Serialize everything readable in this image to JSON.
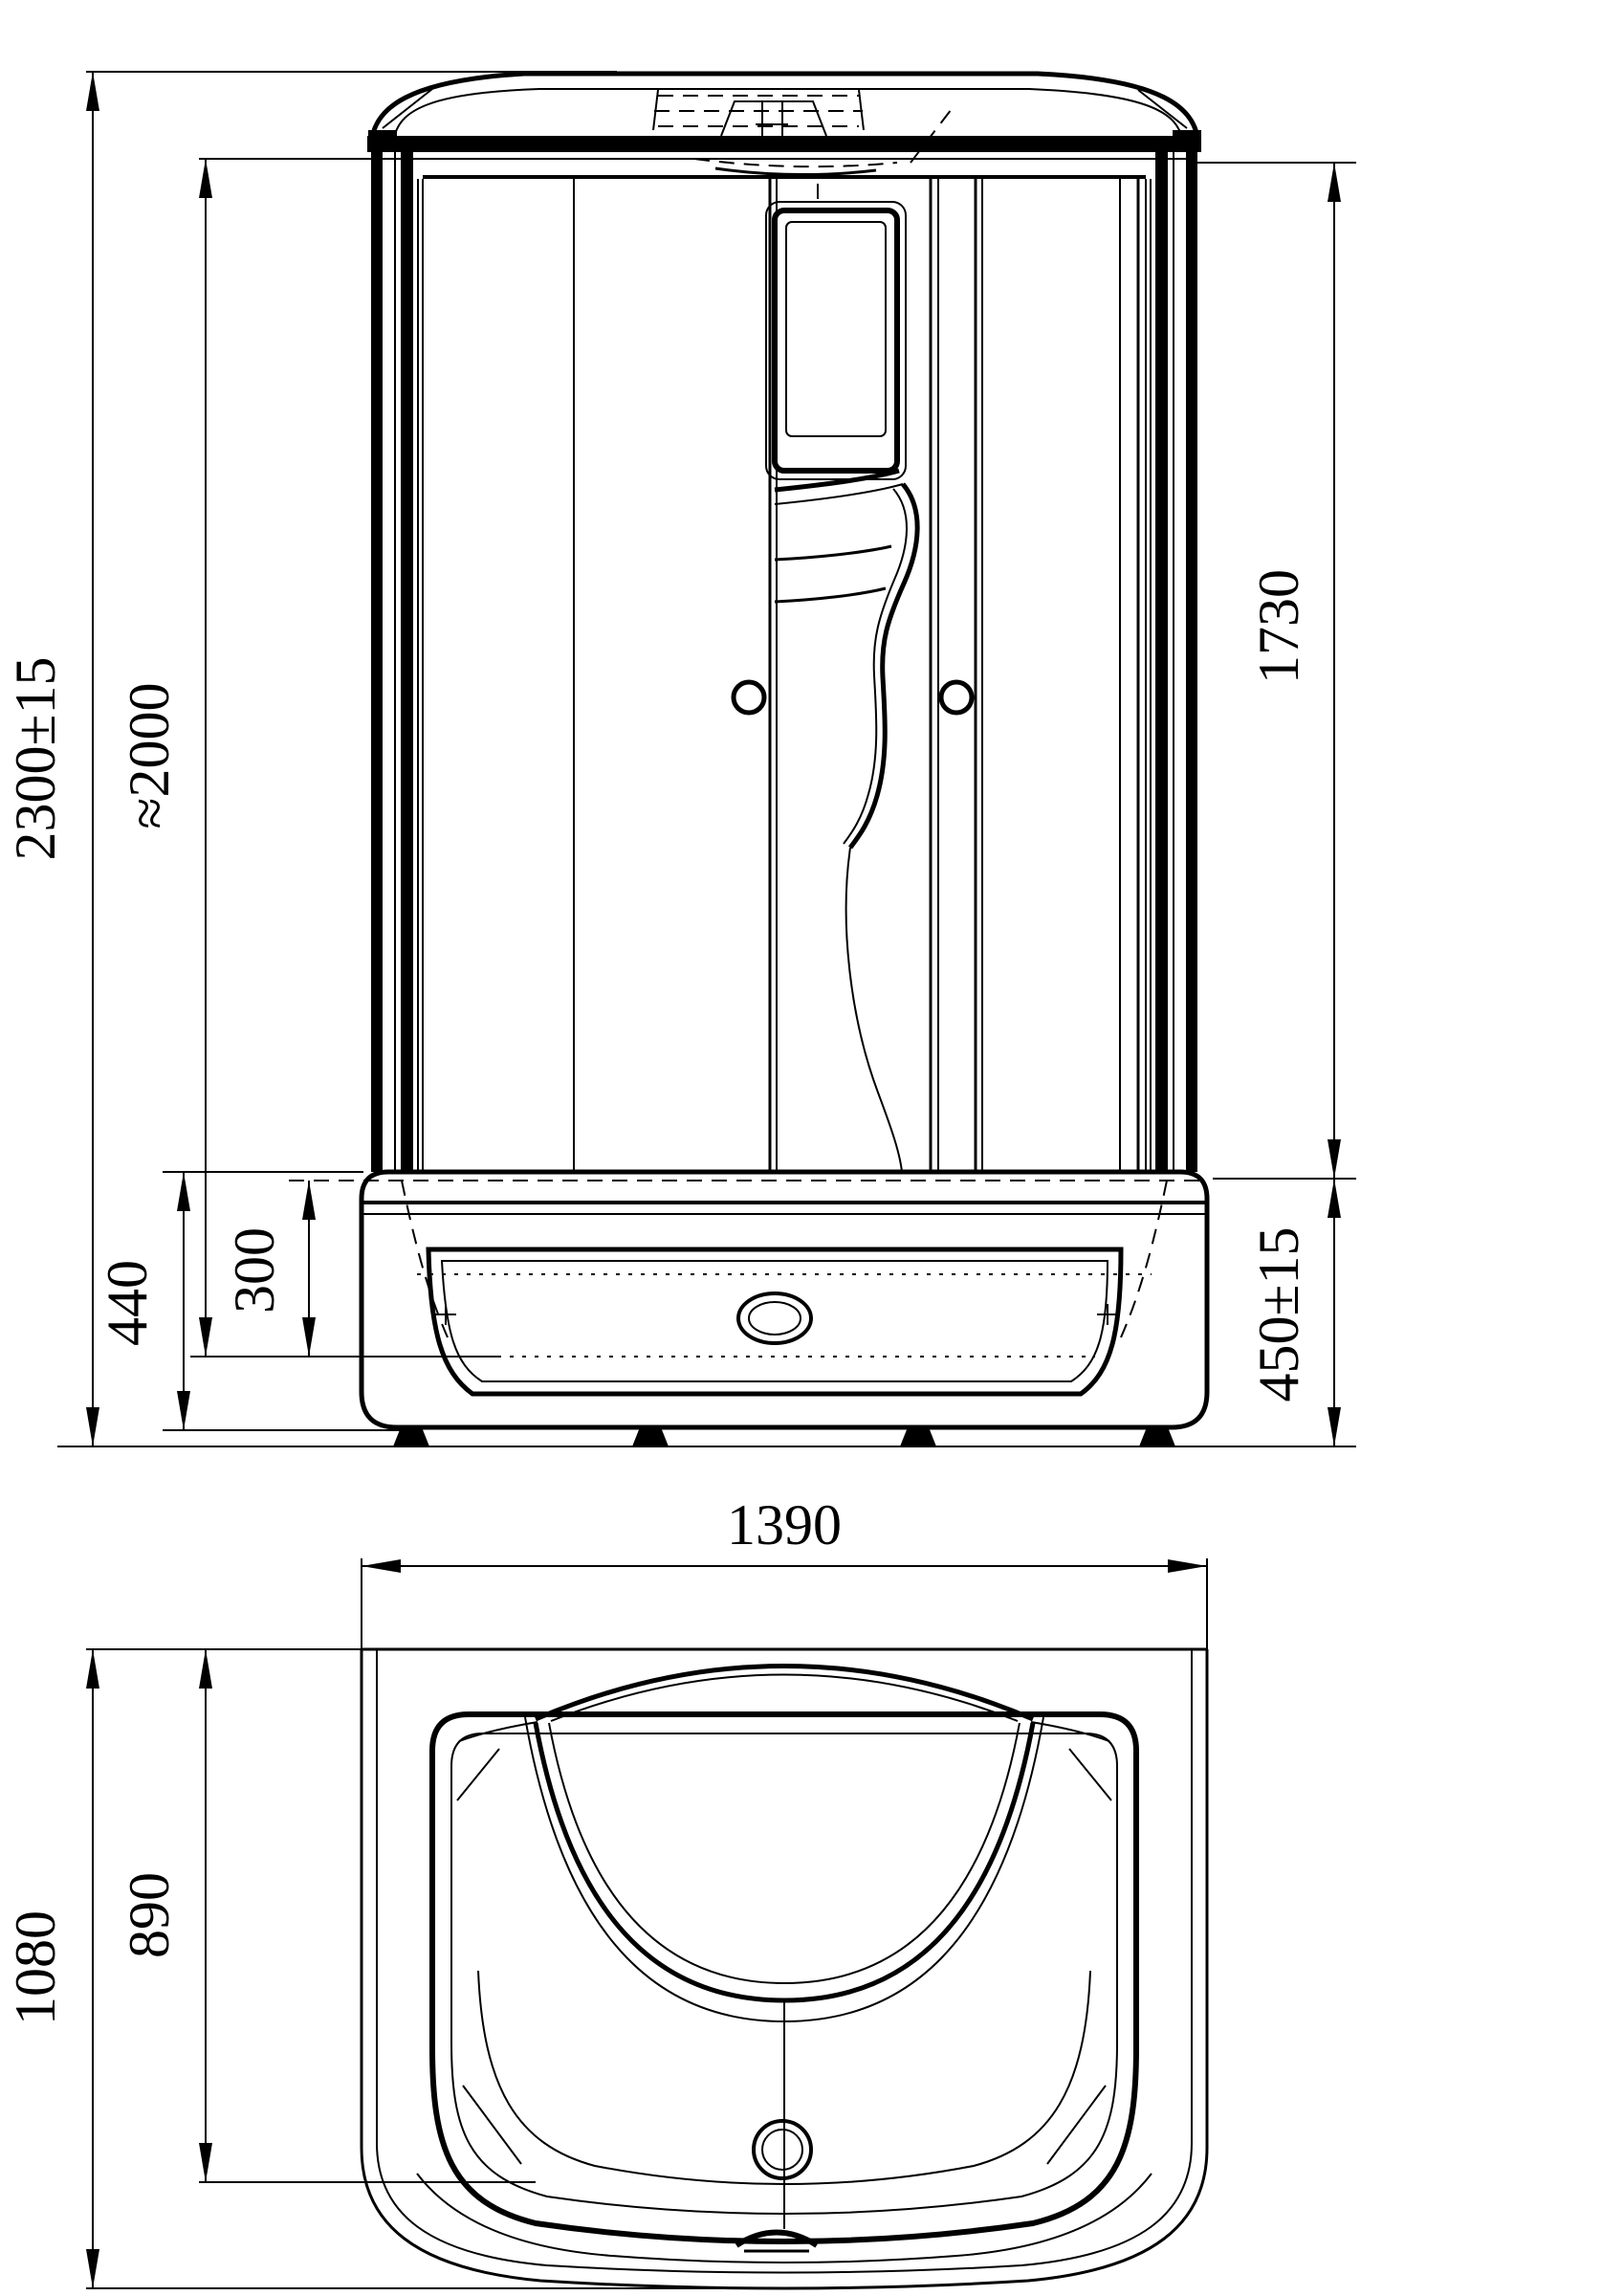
{
  "drawing": {
    "type": "shower-cabin-dimensioned-technical-drawing",
    "units": "mm",
    "front_view": {
      "overall_height": "2300±15",
      "cabin_height": "≈2000",
      "glass_height": "1730",
      "tray_body_height": "440",
      "tray_inner_depth": "300",
      "tray_height_with_feet": "450±15"
    },
    "plan_view": {
      "overall_width": "1390",
      "overall_depth": "1080",
      "inner_depth": "890"
    },
    "line_color": "#000000",
    "background_color": "#ffffff"
  }
}
